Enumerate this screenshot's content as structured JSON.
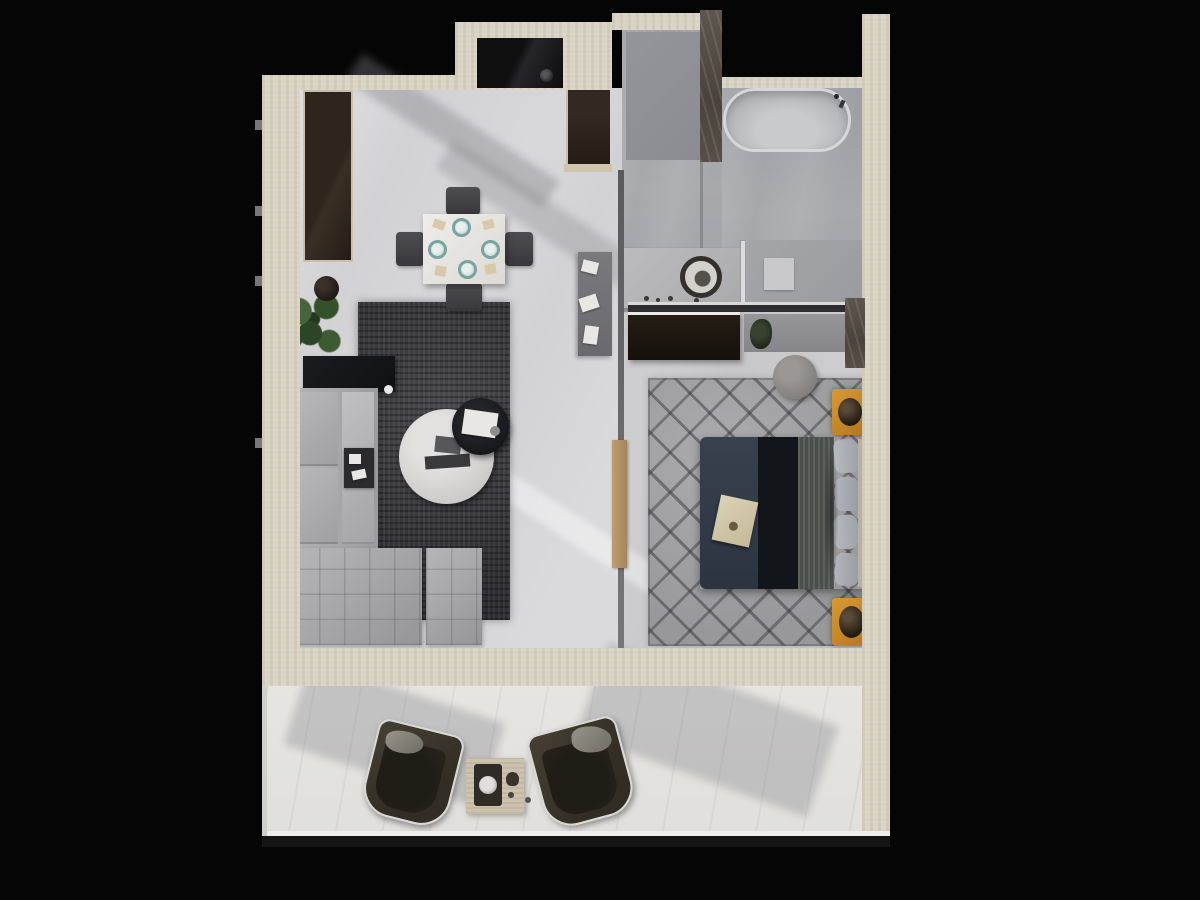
{
  "scene": {
    "kind": "3d-floor-plan-render",
    "style": "top-down architectural visualization, no visible text",
    "background_color": "#050505",
    "canvas": {
      "width": 1200,
      "height": 900
    }
  },
  "palette": {
    "wall_beige": "#d9d3c5",
    "marble_partition": "#4a443d",
    "living_floor": "#d2d2d5",
    "wet_zone_floor": "#a4a5a9",
    "bedroom_floor": "#c7c6c8",
    "balcony_floor": "#e4e3e0",
    "living_rug": "#39383b",
    "bedroom_rug": "#a3a2a4",
    "sofa_gray": "#a9a8aa",
    "bed_duvet_navy": "#333c49",
    "bed_duvet_dark": "#12151a",
    "bed_sheet": "#4b4f4b",
    "pillow_gray": "#b0b3b8",
    "nightstand_gold": "#c5872d",
    "wardrobe_brown": "#241c15",
    "entry_door_brown": "#2f241c",
    "kitchen_block_black": "#121212",
    "balcony_chair_olive": "#3a352c",
    "side_table_travertine": "#cdc2ad",
    "plant_green": "#3d5a33"
  },
  "rooms": {
    "living": {
      "label": "Living and dining room",
      "furniture": [
        "tall wardrobe",
        "potted plant",
        "black console",
        "L-shaped gray sofa",
        "ottoman",
        "dark area rug",
        "round white coffee table",
        "round black side table",
        "square dining table with four place settings",
        "four dining chairs",
        "small desk with papers"
      ]
    },
    "entry": {
      "label": "Entry hall",
      "furniture": [
        "entrance door",
        "black kitchen block with round sink"
      ]
    },
    "bathroom": {
      "label": "Bathroom",
      "furniture": [
        "freestanding bathtub",
        "marble shower partition",
        "vanity counter with round vessel sink",
        "glass divider",
        "shower tray with mat"
      ]
    },
    "bedroom": {
      "label": "Bedroom",
      "furniture": [
        "dark dresser",
        "wall console with plant",
        "chevron patterned rug",
        "round pouf",
        "double bed with navy duvet",
        "breakfast tray on bed",
        "two gold nightstands with dark vases",
        "wooden door"
      ]
    },
    "balcony": {
      "label": "Balcony terrace",
      "furniture": [
        "two olive lounge chairs",
        "travertine side table with tea tray"
      ]
    }
  }
}
